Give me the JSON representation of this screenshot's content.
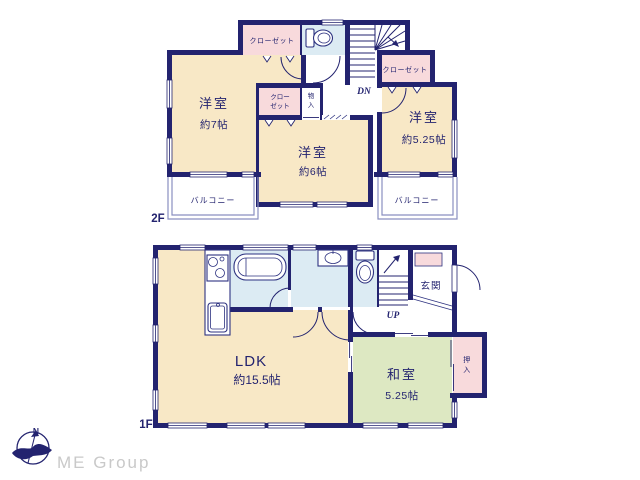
{
  "colors": {
    "wall_navy": "#23236f",
    "room_cream": "#f8e8c6",
    "closet_pink": "#f8dadc",
    "wet_area_blue": "#dcebf3",
    "tatami_green": "#dde8c2",
    "balcony_line": "#8a8fc0",
    "brand_gray": "#c9c9c9"
  },
  "floor2": {
    "floor_label": "2F",
    "room7_name": "洋室",
    "room7_size": "約7帖",
    "room6_name": "洋室",
    "room6_size": "約6帖",
    "room525_name": "洋室",
    "room525_size": "約5.25帖",
    "closet_top": "クローゼット",
    "closet_right": "クローゼット",
    "closet_inner_l1": "クロー",
    "closet_inner_l2": "ゼット",
    "storage_l1": "物",
    "storage_l2": "入",
    "balcony_left": "バルコニー",
    "balcony_right": "バルコニー",
    "stair_direction": "DN"
  },
  "floor1": {
    "floor_label": "1F",
    "ldk_name": "LDK",
    "ldk_size": "約15.5帖",
    "washitsu_name": "和室",
    "washitsu_size": "5.25帖",
    "genkan": "玄関",
    "oshiire_l1": "押",
    "oshiire_l2": "入",
    "stair_direction": "UP"
  },
  "compass": {
    "north": "N"
  },
  "brand": {
    "logo_text": "ME Group"
  }
}
